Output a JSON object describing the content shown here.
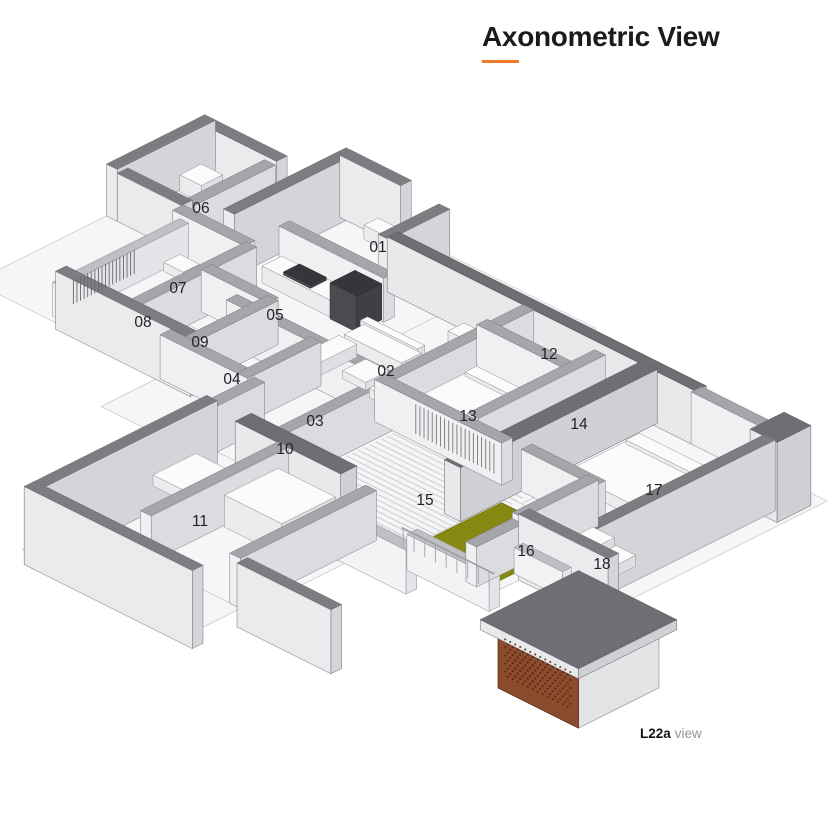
{
  "title": {
    "text": "Axonometric View"
  },
  "caption": {
    "label": "L22a",
    "suffix": "view"
  },
  "accent": {
    "orange": "#F07A28",
    "green": "#868A12",
    "green_edge": "#6E7310",
    "brick": "#8C4B2D",
    "brick_edge": "#5D2F1A",
    "brick_dot": "#46220D",
    "label_color": "#232327"
  },
  "room_labels": [
    {
      "id": "01",
      "x": 378,
      "y": 247
    },
    {
      "id": "02",
      "x": 386,
      "y": 371
    },
    {
      "id": "03",
      "x": 315,
      "y": 421
    },
    {
      "id": "04",
      "x": 232,
      "y": 379
    },
    {
      "id": "05",
      "x": 275,
      "y": 315
    },
    {
      "id": "06",
      "x": 201,
      "y": 208
    },
    {
      "id": "07",
      "x": 178,
      "y": 288
    },
    {
      "id": "08",
      "x": 143,
      "y": 322
    },
    {
      "id": "09",
      "x": 200,
      "y": 342
    },
    {
      "id": "10",
      "x": 285,
      "y": 449
    },
    {
      "id": "11",
      "x": 200,
      "y": 521
    },
    {
      "id": "12",
      "x": 549,
      "y": 354
    },
    {
      "id": "13",
      "x": 468,
      "y": 416
    },
    {
      "id": "14",
      "x": 579,
      "y": 424
    },
    {
      "id": "15",
      "x": 425,
      "y": 500
    },
    {
      "id": "16",
      "x": 526,
      "y": 551
    },
    {
      "id": "17",
      "x": 654,
      "y": 490
    },
    {
      "id": "18",
      "x": 602,
      "y": 564
    }
  ]
}
